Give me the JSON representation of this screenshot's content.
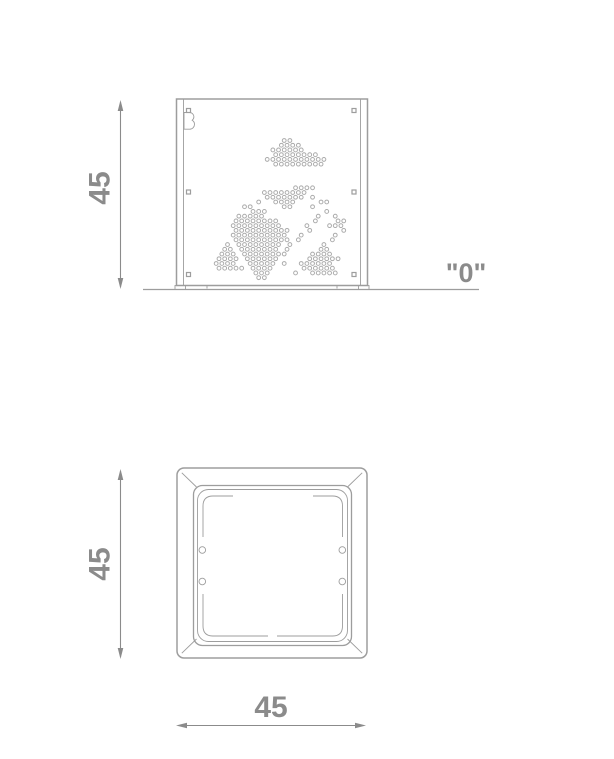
{
  "labels": {
    "front_height": "45",
    "plan_height": "45",
    "plan_width": "45",
    "ground_level": "\"0\""
  },
  "front_view": {
    "logo": "B",
    "fastener_count": 6
  },
  "colors": {
    "line": "#9d9d9d",
    "dim": "#8b8b8b",
    "dot": "#ababab"
  },
  "perforation": {
    "origin_x": 210.5,
    "origin_y": 140.5,
    "pitch_x": 5.67,
    "pitch_y": 4.73,
    "dot_radius": 1.9,
    "rows": [
      ".............oo..........",
      "............oooo.........",
      "...........oooooo........",
      "...........oooooooo......",
      "..........ooooooooooo....",
      "...........ooooooooo.....",
      ".........................",
      ".........................",
      ".........................",
      ".........................",
      "...............oooo......",
      ".........oooooooo........",
      "..........ooooooo.o......",
      "........o..oooo....oo....",
      "......oo.....oo...o......",
      ".......ooo..........o....",
      ".....ooooo.........o..o..",
      "....oooooooo......o...oo.",
      "....ooooooooo....o...ooo.",
      "....oooooooooo...o.....o.",
      "....oooooooooo..o.....o..",
      "....oooooooooo.o.....o...",
      "...o.oooooooo.o.....o....",
      "..oo.ooooooo.o.....oo....",
      "..ooo.oooooooo....oooo...",
      ".oooo.oooooo.....oooooo..",
      ".oooo..ooooo.o..oooooo...",
      ".ooooo.oooo.....oooooo...",
      "........ooo....o..ooooo..",
      "........oo..............."
    ]
  }
}
